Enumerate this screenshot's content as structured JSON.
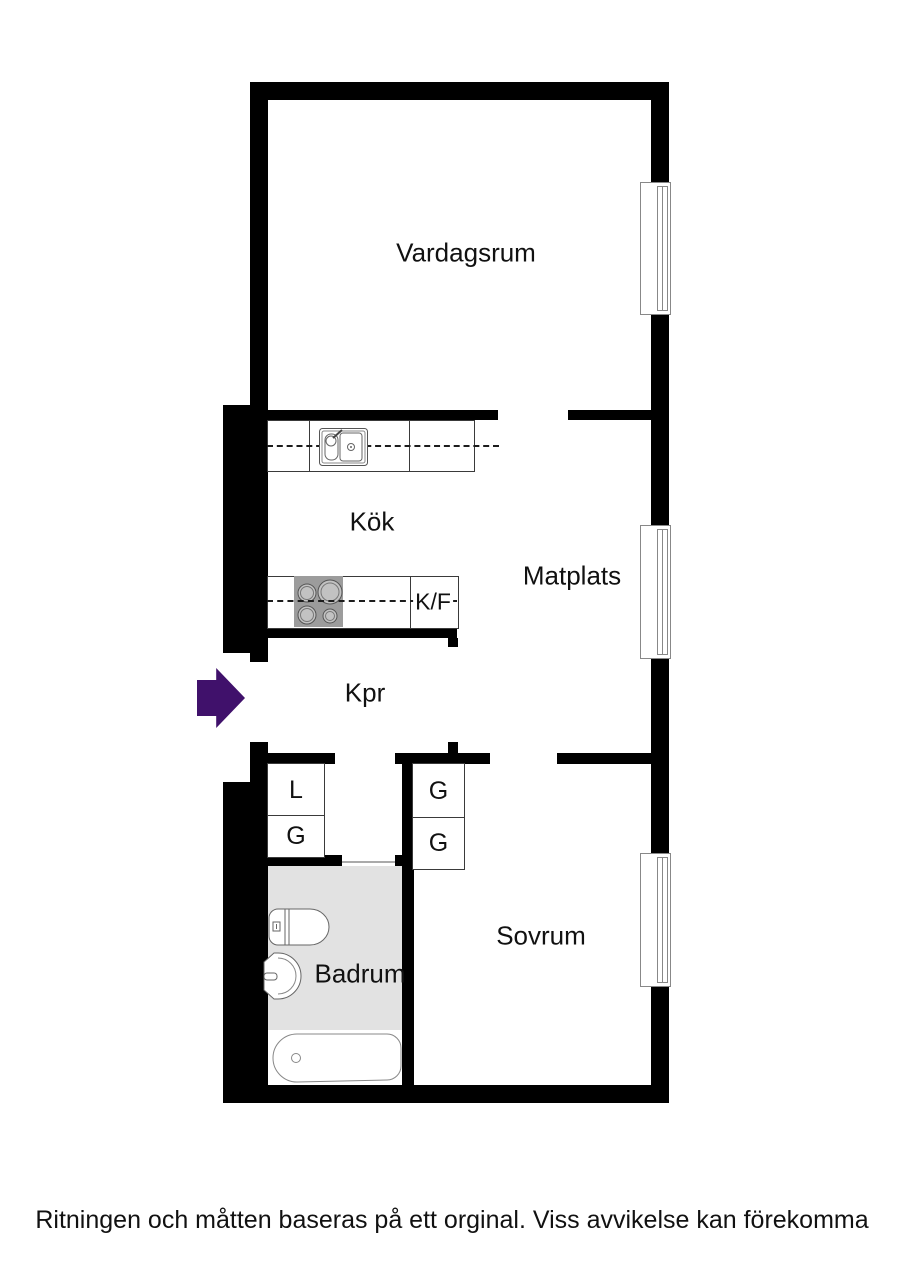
{
  "colors": {
    "wall": "#000000",
    "floor-gray": "#e2e2e2",
    "arrow": "#40116b",
    "stove": "#9c9c9c"
  },
  "rooms": {
    "vardagsrum": {
      "label": "Vardagsrum"
    },
    "kok": {
      "label": "Kök"
    },
    "matplats": {
      "label": "Matplats"
    },
    "kpr": {
      "label": "Kpr"
    },
    "sovrum": {
      "label": "Sovrum"
    },
    "badrum": {
      "label": "Badrum"
    }
  },
  "appliances": {
    "fridge_freezer": {
      "label": "K/F"
    }
  },
  "closets": {
    "left": [
      {
        "label": "L"
      },
      {
        "label": "G"
      }
    ],
    "right": [
      {
        "label": "G"
      },
      {
        "label": "G"
      }
    ]
  },
  "footer": {
    "disclaimer": "Ritningen och måtten baseras på ett orginal. Viss avvikelse kan förekomma"
  }
}
